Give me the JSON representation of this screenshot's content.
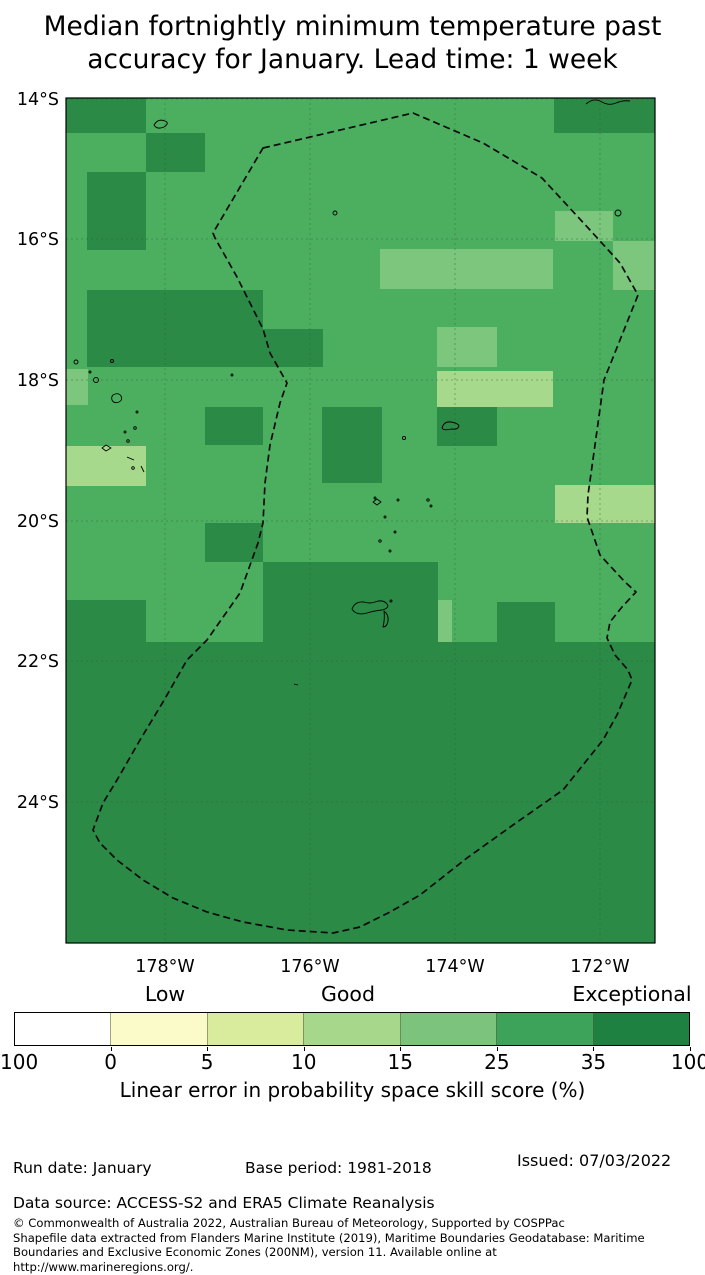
{
  "title": {
    "line1": "Median fortnightly minimum temperature past",
    "line2": "accuracy for January. Lead time: 1 week"
  },
  "map": {
    "frame": {
      "x": 66,
      "y": 98,
      "w": 589,
      "h": 845
    },
    "colors": {
      "base": "#4caf5f",
      "dark": "#2b8a46",
      "light": "#7cc67e",
      "pale": "#a6d98c",
      "grid": "#2f5f3f",
      "eez": "#0a0a0a",
      "frame": "#000000",
      "island": "#000000"
    },
    "lat_ticks": [
      {
        "label": "14°S",
        "y": 99
      },
      {
        "label": "16°S",
        "y": 239
      },
      {
        "label": "18°S",
        "y": 380
      },
      {
        "label": "20°S",
        "y": 521
      },
      {
        "label": "22°S",
        "y": 661
      },
      {
        "label": "24°S",
        "y": 802
      }
    ],
    "lon_ticks": [
      {
        "label": "178°W",
        "x": 165
      },
      {
        "label": "176°W",
        "x": 310
      },
      {
        "label": "174°W",
        "x": 455
      },
      {
        "label": "172°W",
        "x": 600
      }
    ],
    "cells": [
      {
        "bin": "dark",
        "x": 66,
        "y": 98,
        "w": 80,
        "h": 35
      },
      {
        "bin": "dark",
        "x": 146,
        "y": 133,
        "w": 59,
        "h": 39
      },
      {
        "bin": "dark",
        "x": 87,
        "y": 172,
        "w": 59,
        "h": 78
      },
      {
        "bin": "dark",
        "x": 554,
        "y": 98,
        "w": 101,
        "h": 35
      },
      {
        "bin": "dark",
        "x": 87,
        "y": 290,
        "w": 176,
        "h": 77
      },
      {
        "bin": "dark",
        "x": 263,
        "y": 329,
        "w": 60,
        "h": 38
      },
      {
        "bin": "dark",
        "x": 205,
        "y": 407,
        "w": 58,
        "h": 38
      },
      {
        "bin": "dark",
        "x": 322,
        "y": 407,
        "w": 60,
        "h": 76
      },
      {
        "bin": "dark",
        "x": 437,
        "y": 407,
        "w": 60,
        "h": 39
      },
      {
        "bin": "dark",
        "x": 205,
        "y": 523,
        "w": 58,
        "h": 39
      },
      {
        "bin": "dark",
        "x": 66,
        "y": 600,
        "w": 80,
        "h": 42
      },
      {
        "bin": "dark",
        "x": 263,
        "y": 562,
        "w": 175,
        "h": 80
      },
      {
        "bin": "dark",
        "x": 497,
        "y": 602,
        "w": 58,
        "h": 40
      },
      {
        "bin": "dark",
        "x": 66,
        "y": 642,
        "w": 589,
        "h": 301
      },
      {
        "bin": "light",
        "x": 66,
        "y": 369,
        "w": 22,
        "h": 36
      },
      {
        "bin": "light",
        "x": 555,
        "y": 211,
        "w": 58,
        "h": 30
      },
      {
        "bin": "light",
        "x": 613,
        "y": 241,
        "w": 42,
        "h": 49
      },
      {
        "bin": "light",
        "x": 380,
        "y": 249,
        "w": 173,
        "h": 40
      },
      {
        "bin": "light",
        "x": 437,
        "y": 327,
        "w": 60,
        "h": 40
      },
      {
        "bin": "light",
        "x": 438,
        "y": 600,
        "w": 14,
        "h": 42
      },
      {
        "bin": "pale",
        "x": 66,
        "y": 446,
        "w": 80,
        "h": 40
      },
      {
        "bin": "pale",
        "x": 437,
        "y": 371,
        "w": 116,
        "h": 36
      },
      {
        "bin": "pale",
        "x": 555,
        "y": 485,
        "w": 100,
        "h": 38
      }
    ],
    "eez_path": "M263,148 L413,113 L483,143 L542,178 L590,230 L620,263 L638,295 L604,380 L595,445 L588,495 L587,517 L600,555 L625,582 L636,592 L622,607 L610,622 L607,638 L615,655 L628,670 L632,680 L617,715 L603,740 L563,790 L513,825 L467,858 L420,895 L390,912 L360,927 L333,933 L287,930 L243,922 L207,912 L173,898 L143,880 L117,860 L100,843 L93,830 L103,803 L117,780 L140,740 L163,702 L187,660 L207,640 L240,593 L258,543 L263,523 L265,483 L270,445 L280,403 L287,383 L270,353 L263,329 L252,307 L237,277 L215,238 L213,233 Z",
    "islands": [
      {
        "t": "p",
        "d": "M154,125 q4,-7 11,-4 q5,2 -1,6 q-7,3 -10,-2 z"
      },
      {
        "t": "c",
        "cx": 335,
        "cy": 213,
        "r": 2
      },
      {
        "t": "c",
        "cx": 618,
        "cy": 213,
        "r": 3
      },
      {
        "t": "p",
        "d": "M586,104 q8,-7 16,-2 q7,4 14,1 q7,-3 14,-2"
      },
      {
        "t": "c",
        "cx": 76,
        "cy": 362,
        "r": 2
      },
      {
        "t": "c",
        "cx": 112,
        "cy": 361,
        "r": 1.5
      },
      {
        "t": "c",
        "cx": 96,
        "cy": 380,
        "r": 2.5
      },
      {
        "t": "c",
        "cx": 90,
        "cy": 372,
        "r": 1
      },
      {
        "t": "p",
        "d": "M113,395 q5,-3 8,1 q2,4 -2,6 q-5,2 -7,-2 q-1,-3 1,-5 z"
      },
      {
        "t": "c",
        "cx": 137,
        "cy": 412,
        "r": 1
      },
      {
        "t": "c",
        "cx": 135,
        "cy": 428,
        "r": 1.3
      },
      {
        "t": "c",
        "cx": 125,
        "cy": 432,
        "r": 1
      },
      {
        "t": "c",
        "cx": 128,
        "cy": 441,
        "r": 1.3
      },
      {
        "t": "p",
        "d": "M102,448 l4,-3 l5,3 l-5,3 z"
      },
      {
        "t": "p",
        "d": "M127,457 l7,3"
      },
      {
        "t": "c",
        "cx": 133,
        "cy": 468,
        "r": 1.3
      },
      {
        "t": "p",
        "d": "M141,466 l3,6"
      },
      {
        "t": "c",
        "cx": 232,
        "cy": 375,
        "r": 1
      },
      {
        "t": "p",
        "d": "M442,428 q2,-7 9,-6 q7,1 8,4 q-1,4 -8,3 q-7,2 -9,-1 z"
      },
      {
        "t": "c",
        "cx": 404,
        "cy": 438,
        "r": 1.6
      },
      {
        "t": "c",
        "cx": 375,
        "cy": 498,
        "r": 1
      },
      {
        "t": "p",
        "d": "M373,502 l4,-3 l4,3 l-4,3 z"
      },
      {
        "t": "c",
        "cx": 398,
        "cy": 500,
        "r": 1
      },
      {
        "t": "c",
        "cx": 428,
        "cy": 500,
        "r": 1.2
      },
      {
        "t": "c",
        "cx": 431,
        "cy": 506,
        "r": 1
      },
      {
        "t": "c",
        "cx": 385,
        "cy": 517,
        "r": 1
      },
      {
        "t": "c",
        "cx": 395,
        "cy": 532,
        "r": 1
      },
      {
        "t": "c",
        "cx": 380,
        "cy": 541,
        "r": 1.2
      },
      {
        "t": "c",
        "cx": 390,
        "cy": 551,
        "r": 1
      },
      {
        "t": "p",
        "d": "M352,609 q3,-8 12,-7 q6,2 11,0 q8,-3 12,2 q3,4 -5,6 q-9,1 -15,3 q-11,3 -15,-4 z"
      },
      {
        "t": "p",
        "d": "M384,611 q5,4 4,10 q-1,6 -5,6 q2,-8 1,-16 z"
      },
      {
        "t": "c",
        "cx": 391,
        "cy": 601,
        "r": 1
      },
      {
        "t": "p",
        "d": "M294,684 l4,1"
      }
    ]
  },
  "legend": {
    "headers": [
      {
        "text": "Low",
        "x": 165
      },
      {
        "text": "Good",
        "x": 348
      },
      {
        "text": "Exceptional",
        "x": 632
      }
    ],
    "colors": [
      "#ffffff",
      "#fafbc8",
      "#d9ec9e",
      "#a6d78a",
      "#7cc47e",
      "#3da35a",
      "#1e8041"
    ],
    "ticks": [
      "100",
      "0",
      "5",
      "10",
      "15",
      "25",
      "35",
      "100"
    ],
    "caption": "Linear error in probability space skill score (%)"
  },
  "footer": {
    "run_date": "Run date: January",
    "base_period": "Base period: 1981-2018",
    "issued": "Issued: 07/03/2022",
    "data_source": "Data source: ACCESS-S2 and ERA5 Climate Reanalysis",
    "fine_print": [
      "© Commonwealth of Australia 2022, Australian Bureau of Meteorology, Supported by COSPPac",
      "Shapefile data extracted from Flanders Marine Institute (2019), Maritime Boundaries Geodatabase: Maritime",
      "Boundaries and Exclusive Economic Zones (200NM), version 11. Available online at",
      "http://www.marineregions.org/."
    ]
  }
}
